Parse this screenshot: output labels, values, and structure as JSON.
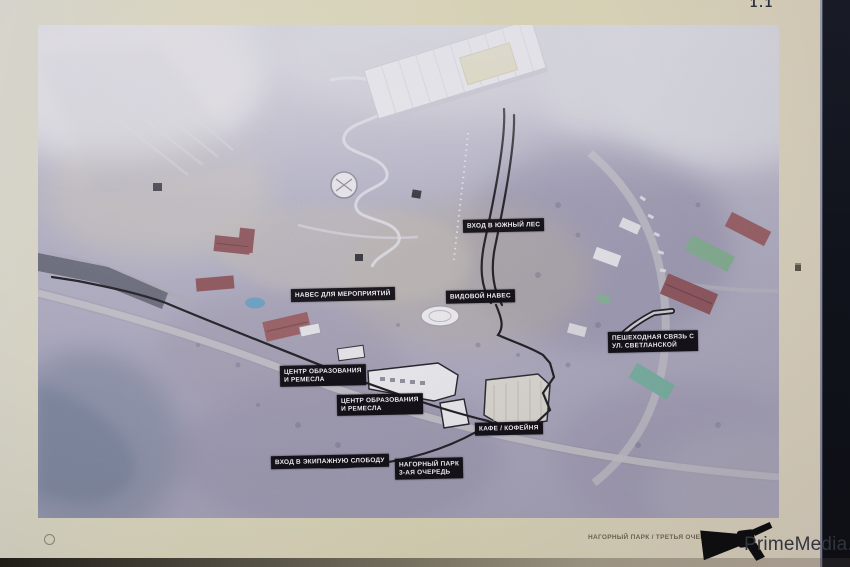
{
  "sheet": {
    "number": "1.1"
  },
  "map": {
    "description": "Аэрофотоплан мастер-плана парка",
    "labels": [
      {
        "name": "south-forest-entrance",
        "lines": [
          "ВХОД В ЮЖНЫЙ ЛЕС"
        ]
      },
      {
        "name": "event-canopy",
        "lines": [
          "НАВЕС ДЛЯ МЕРОПРИЯТИЙ"
        ]
      },
      {
        "name": "viewpoint-canopy",
        "lines": [
          "ВИДОВОЙ НАВЕС"
        ]
      },
      {
        "name": "pedestrian-link-svetlanskaya",
        "lines": [
          "ПЕШЕХОДНАЯ СВЯЗЬ С",
          "УЛ. СВЕТЛАНСКОЙ"
        ]
      },
      {
        "name": "education-crafts-center-upper",
        "lines": [
          "ЦЕНТР ОБРАЗОВАНИЯ",
          "И РЕМЕСЛА"
        ]
      },
      {
        "name": "education-crafts-center-lower",
        "lines": [
          "ЦЕНТР ОБРАЗОВАНИЯ",
          "И РЕМЕСЛА"
        ]
      },
      {
        "name": "cafe-coffeeshop",
        "lines": [
          "КАФЕ / КОФЕЙНЯ"
        ]
      },
      {
        "name": "carriage-sloboda-entrance",
        "lines": [
          "ВХОД В ЭКИПАЖНУЮ СЛОБОДУ"
        ]
      },
      {
        "name": "nagorny-park-phase3",
        "lines": [
          "НАГОРНЫЙ ПАРК",
          "3-АЯ ОЧЕРЕДЬ"
        ]
      }
    ]
  },
  "footer": {
    "project_title": "НАГОРНЫЙ ПАРК / ТРЕТЬЯ ОЧЕРЕДЬ",
    "year": "2023",
    "divider": "|"
  },
  "watermark": {
    "site": "PrimeMedia.ru",
    "icon": "megaphone-icon"
  },
  "colors": {
    "paper": "#d5d1b6",
    "label_background": "#141218",
    "label_text": "#eceaf0",
    "backdrop": "#10131c",
    "plan_outline": "#17161d"
  }
}
